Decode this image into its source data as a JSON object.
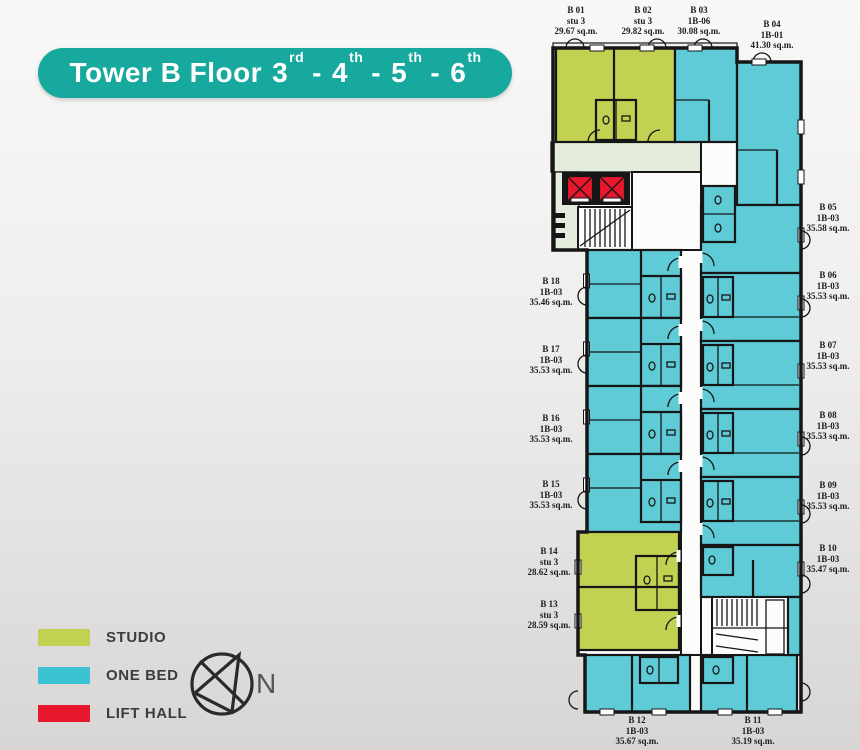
{
  "title": {
    "prefix": "Tower B Floor",
    "separator": "-",
    "floors": [
      {
        "num": "3",
        "ord": "rd"
      },
      {
        "num": "4",
        "ord": "th"
      },
      {
        "num": "5",
        "ord": "th"
      },
      {
        "num": "6",
        "ord": "th"
      }
    ]
  },
  "legend": {
    "items": [
      {
        "label": "STUDIO",
        "color": "#c3d152"
      },
      {
        "label": "ONE BED",
        "color": "#3cc3d2"
      },
      {
        "label": "LIFT HALL",
        "color": "#e7182d"
      }
    ]
  },
  "compass": {
    "label": "N"
  },
  "colors": {
    "banner": "#17a89e",
    "studio": "#c3d152",
    "one_bed": "#5ecbd7",
    "lift_hall": "#e7182d",
    "corridor": "#e4ecdd"
  },
  "units": [
    {
      "id": "B 01",
      "type": "stu 3",
      "area": "29.67 sq.m."
    },
    {
      "id": "B 02",
      "type": "stu 3",
      "area": "29.82 sq.m."
    },
    {
      "id": "B 03",
      "type": "1B-06",
      "area": "30.08 sq.m."
    },
    {
      "id": "B 04",
      "type": "1B-01",
      "area": "41.30 sq.m."
    },
    {
      "id": "B 05",
      "type": "1B-03",
      "area": "35.58 sq.m."
    },
    {
      "id": "B 06",
      "type": "1B-03",
      "area": "35.53 sq.m."
    },
    {
      "id": "B 07",
      "type": "1B-03",
      "area": "35.53 sq.m."
    },
    {
      "id": "B 08",
      "type": "1B-03",
      "area": "35.53 sq.m."
    },
    {
      "id": "B 09",
      "type": "1B-03",
      "area": "35.53 sq.m."
    },
    {
      "id": "B 10",
      "type": "1B-03",
      "area": "35.47 sq.m."
    },
    {
      "id": "B 11",
      "type": "1B-03",
      "area": "35.19 sq.m."
    },
    {
      "id": "B 12",
      "type": "1B-03",
      "area": "35.67 sq.m."
    },
    {
      "id": "B 13",
      "type": "stu 3",
      "area": "28.59 sq.m."
    },
    {
      "id": "B 14",
      "type": "stu 3",
      "area": "28.62 sq.m."
    },
    {
      "id": "B 15",
      "type": "1B-03",
      "area": "35.53 sq.m."
    },
    {
      "id": "B 16",
      "type": "1B-03",
      "area": "35.53 sq.m."
    },
    {
      "id": "B 17",
      "type": "1B-03",
      "area": "35.53 sq.m."
    },
    {
      "id": "B 18",
      "type": "1B-03",
      "area": "35.46 sq.m."
    }
  ]
}
